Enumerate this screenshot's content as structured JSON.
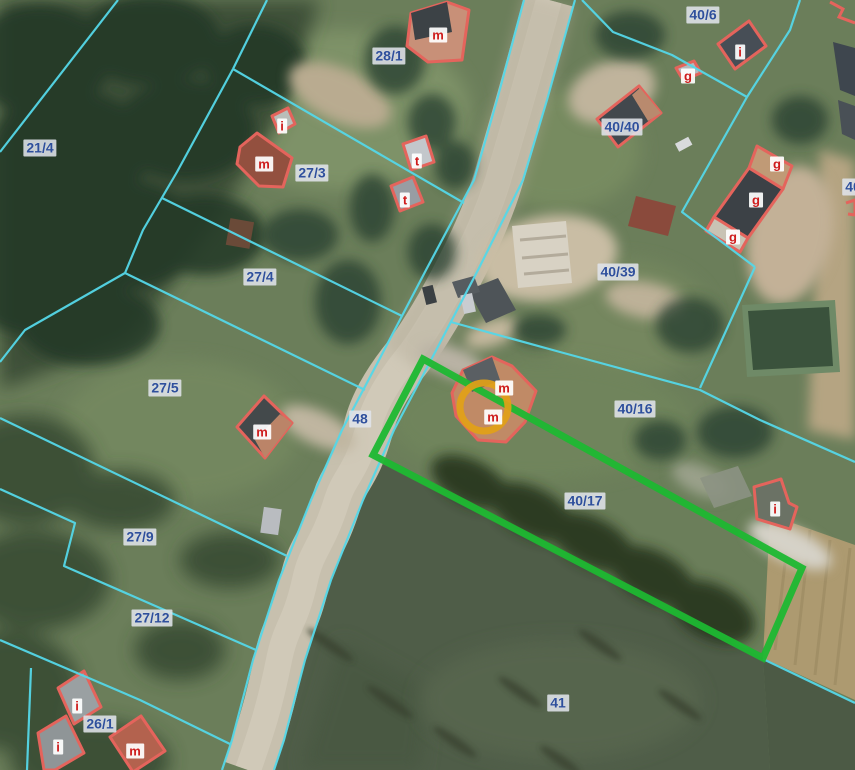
{
  "map": {
    "description": "Aerial orthophoto with cadastral overlay: parcel boundaries, building outlines, highlighted parcel and circle marker",
    "colors": {
      "parcel_line": "#55d7e8",
      "parcel_label_text": "#2e4f9c",
      "building_outline": "#e4645c",
      "building_label_text": "#ce1c1c",
      "highlight_parcel": "#1db832",
      "marker_circle": "#e2a117"
    },
    "parcel_labels": [
      {
        "text": "21/4"
      },
      {
        "text": "28/1"
      },
      {
        "text": "27/3"
      },
      {
        "text": "27/4"
      },
      {
        "text": "27/5"
      },
      {
        "text": "48"
      },
      {
        "text": "27/9"
      },
      {
        "text": "27/12"
      },
      {
        "text": "26/1"
      },
      {
        "text": "40/6"
      },
      {
        "text": "40/40"
      },
      {
        "text": "40/39"
      },
      {
        "text": "40/16"
      },
      {
        "text": "40/17"
      },
      {
        "text": "41"
      },
      {
        "text": "40"
      }
    ],
    "building_labels": [
      {
        "text": "m"
      },
      {
        "text": "i"
      },
      {
        "text": "m"
      },
      {
        "text": "t"
      },
      {
        "text": "t"
      },
      {
        "text": "i"
      },
      {
        "text": "g"
      },
      {
        "text": "g"
      },
      {
        "text": "g"
      },
      {
        "text": "g"
      },
      {
        "text": "m"
      },
      {
        "text": "m"
      },
      {
        "text": "m"
      },
      {
        "text": "i"
      },
      {
        "text": "i"
      },
      {
        "text": "i"
      },
      {
        "text": "m"
      }
    ],
    "highlight": {
      "type": "selected-parcel-outline"
    },
    "marker": {
      "type": "circle-marker"
    }
  }
}
